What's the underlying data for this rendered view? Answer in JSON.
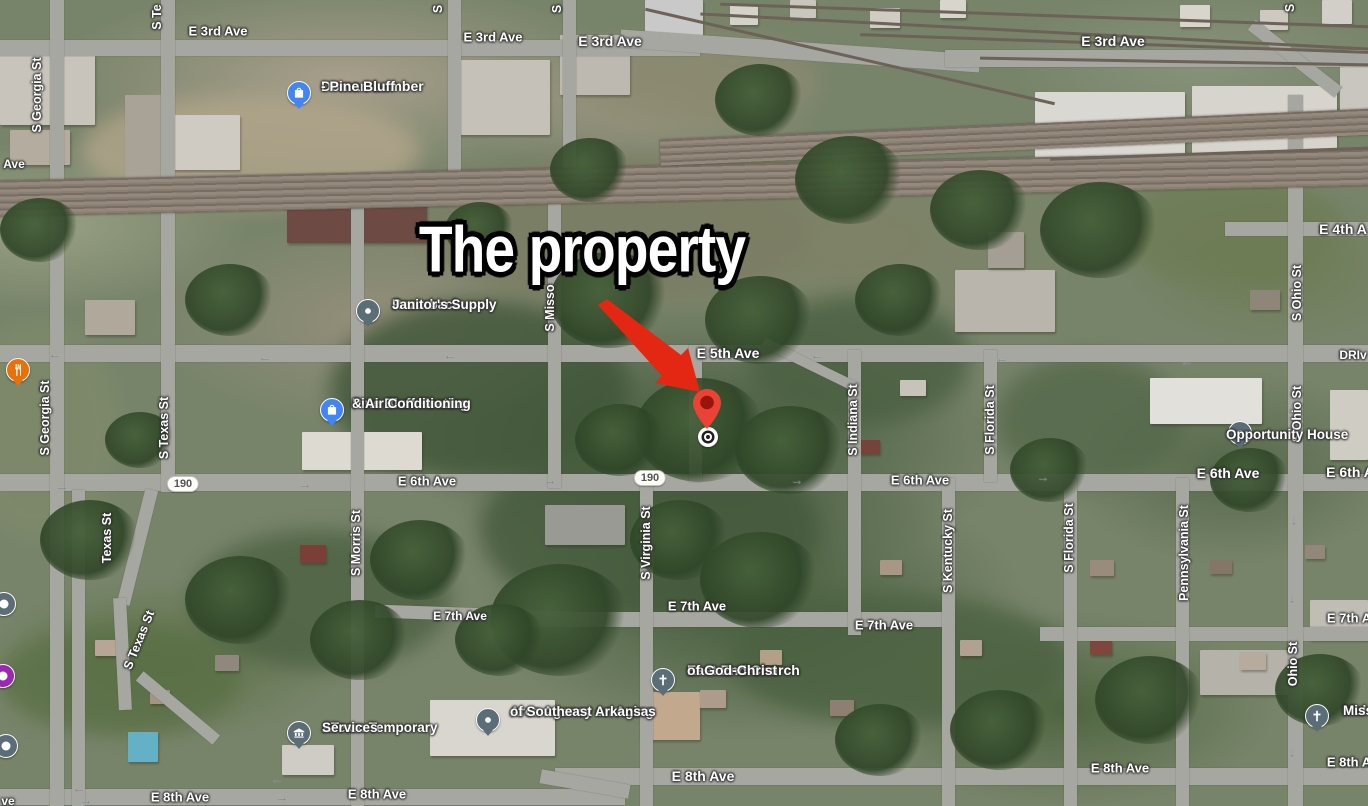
{
  "annotation": {
    "title": "The property",
    "arrow_color": "#e42712"
  },
  "property_marker": {
    "pin_color": "#ea4335",
    "pin_inner_color": "#97150c",
    "x": 707,
    "y": 405,
    "target_x": 708,
    "target_y": 437
  },
  "route_shields": [
    {
      "text": "190",
      "x": 183,
      "y": 484
    },
    {
      "text": "190",
      "x": 650,
      "y": 478
    }
  ],
  "road_labels": [
    {
      "text": "E 3rd Ave",
      "x": 218,
      "y": 31,
      "size": 13
    },
    {
      "text": "E 3rd Ave",
      "x": 493,
      "y": 37,
      "size": 13
    },
    {
      "text": "E 3rd Ave",
      "x": 610,
      "y": 41,
      "size": 14
    },
    {
      "text": "E 3rd Ave",
      "x": 1113,
      "y": 41,
      "size": 14
    },
    {
      "text": "E 4th A",
      "x": 1343,
      "y": 229,
      "size": 14
    },
    {
      "text": "E 5th Ave",
      "x": 728,
      "y": 353,
      "size": 14
    },
    {
      "text": "DRIv",
      "x": 1353,
      "y": 355,
      "size": 12
    },
    {
      "text": "E 6th Ave",
      "x": 427,
      "y": 481,
      "size": 13
    },
    {
      "text": "E 6th Ave",
      "x": 920,
      "y": 480,
      "size": 13
    },
    {
      "text": "E 6th Ave",
      "x": 1228,
      "y": 473,
      "size": 14
    },
    {
      "text": "E 6th A",
      "x": 1350,
      "y": 472,
      "size": 14
    },
    {
      "text": "E 7th Ave",
      "x": 460,
      "y": 616,
      "size": 12
    },
    {
      "text": "E 7th Ave",
      "x": 697,
      "y": 606,
      "size": 13
    },
    {
      "text": "E 7th Ave",
      "x": 884,
      "y": 625,
      "size": 13
    },
    {
      "text": "E 7th A",
      "x": 1349,
      "y": 618,
      "size": 13
    },
    {
      "text": "E 8th Ave",
      "x": 180,
      "y": 797,
      "size": 13
    },
    {
      "text": "E 8th Ave",
      "x": 377,
      "y": 794,
      "size": 13
    },
    {
      "text": "E 8th Ave",
      "x": 703,
      "y": 776,
      "size": 14
    },
    {
      "text": "E 8th Ave",
      "x": 1120,
      "y": 768,
      "size": 13
    },
    {
      "text": "E 8th A",
      "x": 1349,
      "y": 762,
      "size": 13
    },
    {
      "text": "Ave",
      "x": 14,
      "y": 164,
      "size": 12
    },
    {
      "text": "ve",
      "x": 8,
      "y": 801,
      "size": 12
    }
  ],
  "street_labels": [
    {
      "text": "S Georgia St",
      "x": 37,
      "y": 95
    },
    {
      "text": "S Te",
      "x": 157,
      "y": 17
    },
    {
      "text": "S",
      "x": 438,
      "y": 9
    },
    {
      "text": "S",
      "x": 557,
      "y": 9
    },
    {
      "text": "S",
      "x": 1290,
      "y": 8
    },
    {
      "text": "S Misso",
      "x": 550,
      "y": 308
    },
    {
      "text": "S Georgia St",
      "x": 45,
      "y": 418
    },
    {
      "text": "S Texas St",
      "x": 164,
      "y": 428
    },
    {
      "text": "Texas St",
      "x": 107,
      "y": 538
    },
    {
      "text": "S Texas St",
      "x": 139,
      "y": 640,
      "rot": -68
    },
    {
      "text": "S Morris St",
      "x": 356,
      "y": 543
    },
    {
      "text": "S Virginia St",
      "x": 646,
      "y": 543
    },
    {
      "text": "S Indiana St",
      "x": 853,
      "y": 420
    },
    {
      "text": "S Kentucky St",
      "x": 948,
      "y": 551
    },
    {
      "text": "S Florida St",
      "x": 990,
      "y": 420
    },
    {
      "text": "S Florida St",
      "x": 1069,
      "y": 538
    },
    {
      "text": "Pennsylvania St",
      "x": 1184,
      "y": 553
    },
    {
      "text": "S Ohio St",
      "x": 1297,
      "y": 293
    },
    {
      "text": "S Ohio St",
      "x": 1297,
      "y": 414
    },
    {
      "text": "Ohio St",
      "x": 1293,
      "y": 664
    }
  ],
  "traffic_arrows": [
    {
      "glyph": "←",
      "x": 55,
      "y": 354
    },
    {
      "glyph": "←",
      "x": 265,
      "y": 357
    },
    {
      "glyph": "←",
      "x": 450,
      "y": 355
    },
    {
      "glyph": "←",
      "x": 817,
      "y": 355
    },
    {
      "glyph": "←",
      "x": 1002,
      "y": 358
    },
    {
      "glyph": "←",
      "x": 1187,
      "y": 361
    },
    {
      "glyph": "→",
      "x": 62,
      "y": 486
    },
    {
      "glyph": "→",
      "x": 305,
      "y": 484
    },
    {
      "glyph": "→",
      "x": 550,
      "y": 480
    },
    {
      "glyph": "→",
      "x": 797,
      "y": 480
    },
    {
      "glyph": "→",
      "x": 1043,
      "y": 477
    },
    {
      "glyph": "←",
      "x": 277,
      "y": 779
    },
    {
      "glyph": "→",
      "x": 282,
      "y": 797
    },
    {
      "glyph": "←",
      "x": 79,
      "y": 788
    },
    {
      "glyph": "→",
      "x": 86,
      "y": 800
    },
    {
      "glyph": "↓",
      "x": 1294,
      "y": 520
    },
    {
      "glyph": "↓",
      "x": 1292,
      "y": 598
    },
    {
      "glyph": "↓",
      "x": 1292,
      "y": 752
    }
  ],
  "pois": [
    {
      "id": "doman-lumber",
      "lines": [
        "Doman Lumber",
        "- Pine Bluff"
      ],
      "icon": "shopping-bag",
      "color": "#4285f4",
      "x": 299,
      "y": 93,
      "text_x": 321,
      "text_y": 78,
      "font": 14
    },
    {
      "id": "razorback-janitors-supply",
      "lines": [
        "Razorback",
        "Janitor's Supply"
      ],
      "icon": "dot",
      "color": "#5b6e78",
      "x": 368,
      "y": 311,
      "text_x": 392,
      "text_y": 296,
      "font": 13.5
    },
    {
      "id": "pine-bluff-heating",
      "lines": [
        "Pine Bluff Heating",
        "& Air Conditioning"
      ],
      "icon": "shopping-bag",
      "color": "#4285f4",
      "x": 332,
      "y": 410,
      "text_x": 352,
      "text_y": 395,
      "font": 13.5
    },
    {
      "id": "opportunity-house",
      "lines": [
        "Opportunity House"
      ],
      "icon": "dot",
      "color": "#5b6e78",
      "x": 1240,
      "y": 433,
      "text_x": 1226,
      "text_y": 426,
      "font": 13.5,
      "side": "left"
    },
    {
      "id": "east-end-church",
      "lines": [
        "East End Church",
        "of God-Christ"
      ],
      "icon": "cross",
      "color": "#5b6e78",
      "x": 663,
      "y": 680,
      "text_x": 687,
      "text_y": 662,
      "font": 14
    },
    {
      "id": "ateam-temporary-services",
      "lines": [
        "ATeam Temporary",
        "Services"
      ],
      "icon": "bank",
      "color": "#5b6e78",
      "x": 299,
      "y": 733,
      "text_x": 322,
      "text_y": 719,
      "font": 13.5
    },
    {
      "id": "area-agency-on-aging",
      "lines": [
        "Area Agency on Aging",
        "of Southeast Arkansas"
      ],
      "icon": "dot",
      "color": "#5b6e78",
      "x": 488,
      "y": 720,
      "text_x": 510,
      "text_y": 703,
      "font": 13.5
    },
    {
      "id": "mulberry-missionary-church",
      "lines": [
        "Mul",
        "Miss"
      ],
      "icon": "cross",
      "color": "#5b6e78",
      "x": 1317,
      "y": 716,
      "text_x": 1343,
      "text_y": 702,
      "font": 13.5
    },
    {
      "id": "restaurant",
      "lines": [],
      "icon": "restaurant",
      "color": "#e8710a",
      "x": 18,
      "y": 370,
      "text_x": 0,
      "text_y": 0,
      "font": 13
    }
  ],
  "edge_pins": [
    {
      "color": "#5b6e78",
      "x": 4,
      "y": 604
    },
    {
      "color": "#9c27b0",
      "x": 3,
      "y": 676
    },
    {
      "color": "#5b6e78",
      "x": 6,
      "y": 746
    }
  ]
}
